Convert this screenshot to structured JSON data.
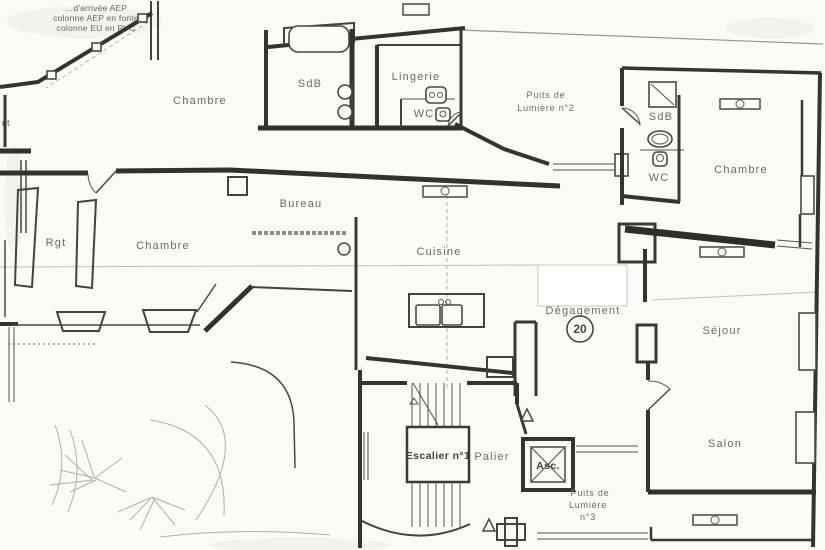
{
  "plan": {
    "corner_note": {
      "line1": "…d'arrivée AEP",
      "line2": "colonne AEP en fonte",
      "line3": "colonne EU en PVC"
    },
    "edge_fragment": "nt",
    "unit_number": "20",
    "rooms": {
      "chambre_nw": "Chambre",
      "sdb_nw": "SdB",
      "lingerie": "Lingerie",
      "wc_nw": "WC",
      "puits_lumiere_2": {
        "line1": "Puits de",
        "line2": "Lumière n°2"
      },
      "sdb_ne": "SdB",
      "wc_ne": "WC",
      "chambre_ne": "Chambre",
      "bureau": "Bureau",
      "rgt": "Rgt",
      "chambre_w": "Chambre",
      "cuisine": "Cuisine",
      "degagement": "Dégagement",
      "sejour": "Séjour",
      "salon": "Salon",
      "escalier": "Escalier n°1",
      "palier": "Palier",
      "ascenseur": "Asc.",
      "puits_lumiere_3": {
        "line1": "Puits de",
        "line2": "Lumière",
        "line3": "n°3"
      }
    },
    "icons": {
      "bathtub": "rounded-rectangle",
      "washbasin": "circle",
      "kitchen-sink": "double-basin",
      "toilet": "rounded-square-with-dot",
      "shower": "square-with-diagonal",
      "radiator": "rectangle-with-circle",
      "elevator": "square-with-x",
      "stairs": "parallel-treads",
      "direction-arrow": "hollow-triangle",
      "door-swing": "quarter-arc"
    },
    "colors": {
      "wall": "#35332f",
      "label": "#6e6a63",
      "paper": "#fbfaf7",
      "bold_label": "#45423d",
      "scan_guide": "#c4c0b8"
    }
  }
}
